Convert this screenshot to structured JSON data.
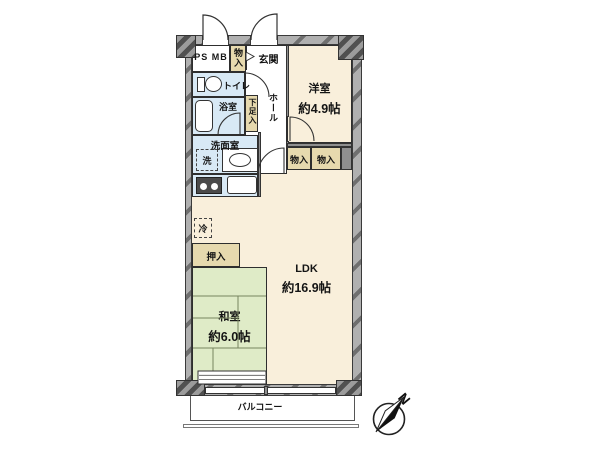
{
  "rooms": {
    "western": {
      "name": "洋室",
      "size": "約4.9帖"
    },
    "ldk": {
      "name": "LDK",
      "size": "約16.9帖"
    },
    "japanese": {
      "name": "和室",
      "size": "約6.0帖"
    },
    "entrance": "玄関",
    "hall": "ホール",
    "toilet": "トイレ",
    "bath": "浴室",
    "washroom": "洗面室",
    "ps_mb": "PS MB"
  },
  "storage": {
    "closet_top": "物入",
    "closet_a": "物入",
    "closet_b": "物入",
    "oshiire": "押入",
    "shoe_box": "下足入"
  },
  "fixtures": {
    "washer": "洗",
    "fridge": "冷"
  },
  "balcony_label": "バルコニー",
  "compass_label": "N",
  "colors": {
    "room_cream": "#F9EFDB",
    "tatami_green": "#DFEBC7",
    "water_blue": "#D8E9F5",
    "storage_tan": "#E6D9AE",
    "wall_gray": "#AFAFAF"
  }
}
